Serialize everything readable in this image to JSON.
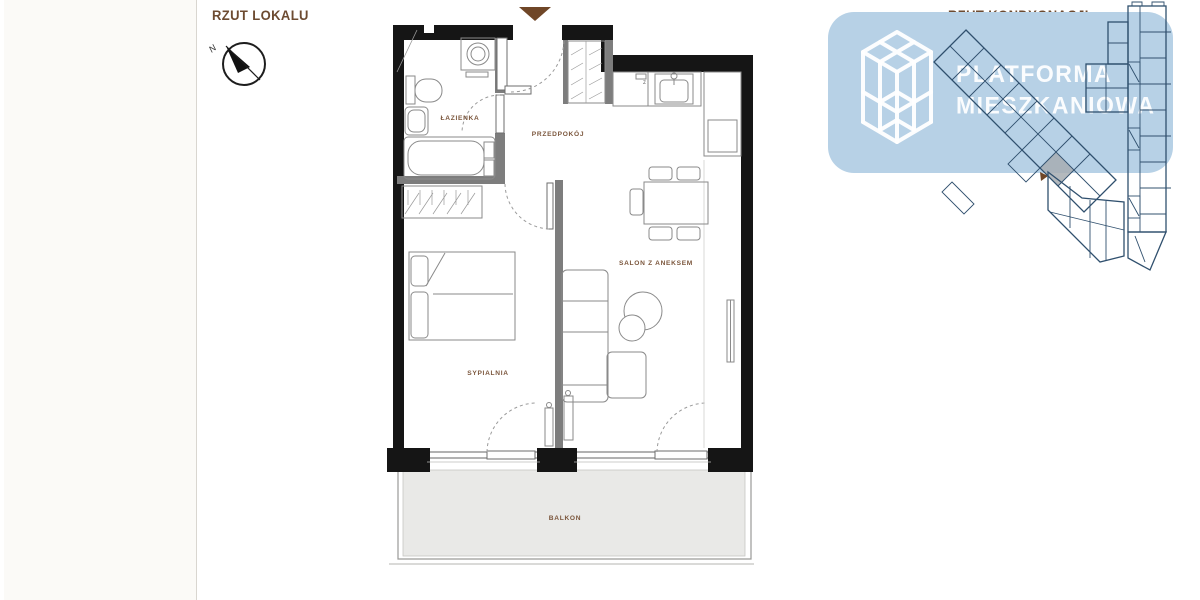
{
  "left_panel": {
    "title": "RZUT LOKALU",
    "compass": {
      "north_label": "N"
    }
  },
  "unit_plan": {
    "rooms": [
      {
        "id": "lazienka",
        "label": "ŁAZIENKA"
      },
      {
        "id": "przedpokoj",
        "label": "PRZEDPOKÓJ"
      },
      {
        "id": "salon",
        "label": "SALON Z ANEKSEM"
      },
      {
        "id": "sypialnia",
        "label": "SYPIALNIA"
      },
      {
        "id": "balkon",
        "label": "BALKON"
      }
    ],
    "kitchen_sink_mark": "z"
  },
  "storey_panel": {
    "title": "RZUT KONDYGNACJI"
  },
  "watermark": {
    "line1": "PLATFORMA",
    "line2": "MIESZKANIOWA"
  },
  "colors": {
    "title_brown": "#6d4b31",
    "label_brown": "#7b563c",
    "entrance_brown": "#6f4627",
    "wall_black": "#151515",
    "interior_grey": "#7d7d7d",
    "furniture_grey": "#8a8a8a",
    "balcony_fill": "#e9e9e7",
    "watermark_blue": "#b7d1e6",
    "storey_line_blue": "#30506e",
    "unit_highlight_grey": "#a7adb2"
  }
}
